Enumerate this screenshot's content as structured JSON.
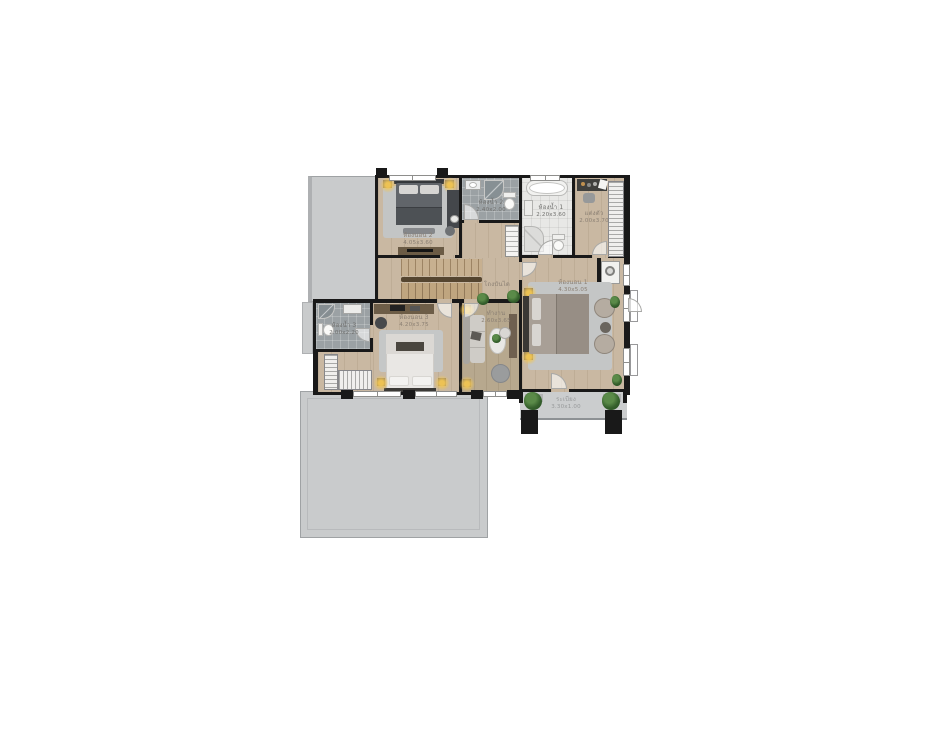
{
  "floor_plan": {
    "background": "#ffffff",
    "labels": {
      "bedroom2": {
        "name": "ห้องนอน 2",
        "dims": "4.05x3.60"
      },
      "bathroom2": {
        "name": "ห้องน้ำ 2",
        "dims": "2.40x2.00"
      },
      "bathroom1": {
        "name": "ห้องน้ำ 1",
        "dims": "2.20x3.60"
      },
      "dressing": {
        "name": "แต่งตัว",
        "dims": "2.00x3.70"
      },
      "stair_hall": {
        "name": "โถงบันได",
        "dims": ""
      },
      "bedroom1": {
        "name": "ห้องนอน 1",
        "dims": "4.30x5.05"
      },
      "bathroom3": {
        "name": "ห้องน้ำ 3",
        "dims": "2.00x2.20"
      },
      "bedroom3": {
        "name": "ห้องนอน 3",
        "dims": "4.20x3.75"
      },
      "office": {
        "name": "ทำงาน",
        "dims": "2.60x3.65"
      },
      "balcony": {
        "name": "ระเบียง",
        "dims": "3.30x1.00"
      }
    },
    "colors": {
      "wall": "#191919",
      "wood_floor": "#c9b8a2",
      "wood_floor_dark": "#b7a88e",
      "tile_gray": "#9ba1a4",
      "tile_white": "#e8e8e6",
      "roof_gray": "#c9cbcc",
      "balcony_gray": "#cbcdce",
      "label_text": "#8a7f73",
      "plant_green": "#35602c",
      "lamp_glow": "#f2c653"
    },
    "icons": {
      "plant": "green round shrub symbol",
      "lamp_glow": "warm radial light spot",
      "window": "white bar with center mullion line",
      "door_swing": "white quarter-circle arc",
      "ac_unit": "black pad outside balcony"
    }
  }
}
